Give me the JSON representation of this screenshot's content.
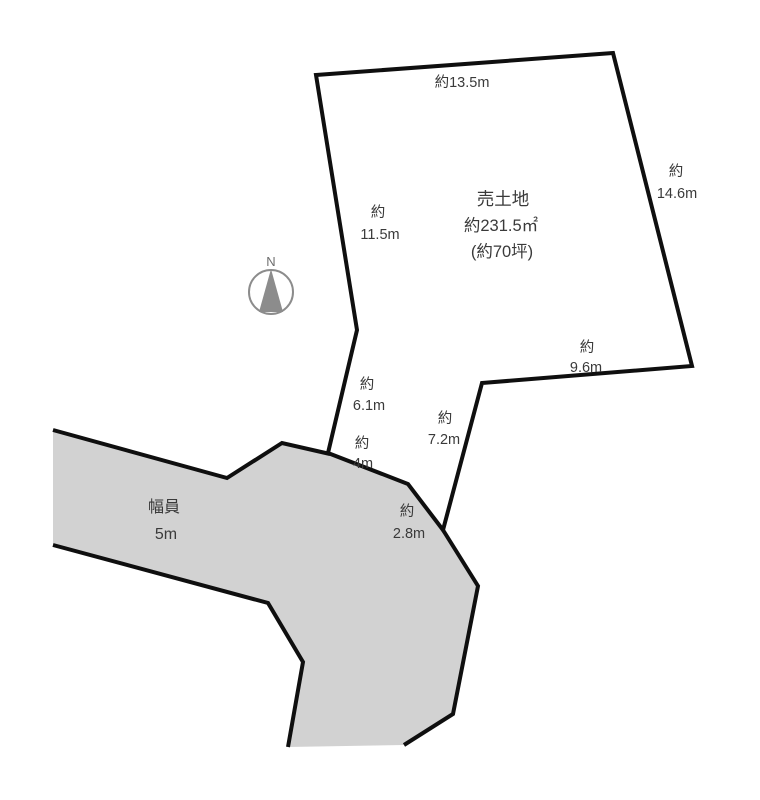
{
  "compass": {
    "north_label": "N"
  },
  "parcel": {
    "title": "売土地",
    "area_sqm": "約231.5㎡",
    "area_tsubo": "(約70坪)",
    "fill_color": "#dce7d1",
    "dimensions": {
      "top_edge": {
        "text": "約13.5m"
      },
      "right_edge": {
        "prefix": "約",
        "value": "14.6m"
      },
      "upper_left_edge": {
        "prefix": "約",
        "value": "11.5m"
      },
      "lower_right_edge": {
        "prefix": "約",
        "value": "9.6m"
      },
      "lower_left_edge": {
        "prefix": "約",
        "value": "6.1m"
      },
      "appendix_right_edge": {
        "prefix": "約",
        "value": "7.2m"
      },
      "appendix_upper_edge": {
        "prefix": "約",
        "value": "4m"
      },
      "appendix_lower_edge": {
        "prefix": "約",
        "value": "2.8m"
      }
    }
  },
  "road": {
    "label": "幅員",
    "width_value": "5m",
    "fill_color": "#d2d2d2"
  },
  "colors": {
    "outline": "#0f0f0f",
    "text": "#3a3a3a",
    "compass": "#8c8c8c",
    "background": "#ffffff"
  }
}
